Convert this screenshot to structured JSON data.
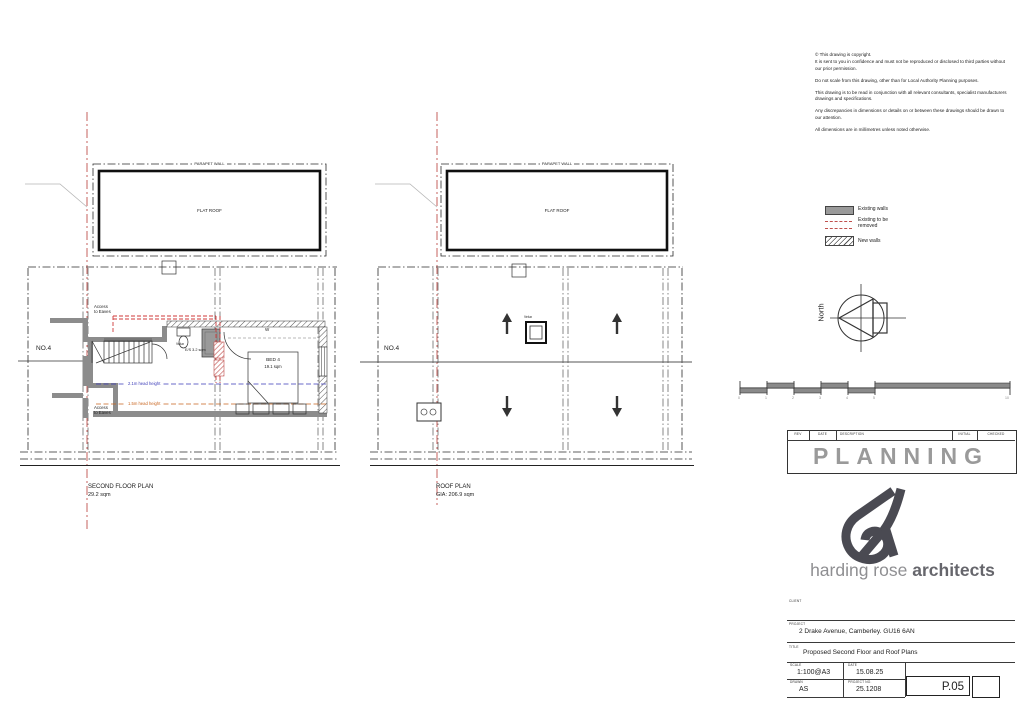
{
  "drawing_notes": {
    "paragraphs": [
      "© This drawing is copyright.",
      "It is sent to you in confidence and must not be reproduced or disclosed to third parties without our prior permission.",
      "Do not scale from this drawing, other than for Local Authority Planning purposes.",
      "This drawing is to be read in conjunction with all relevant consultants, specialist manufacturers drawings and specifications.",
      "Any discrepancies in dimensions or details on or between these drawings should be drawn to our attention.",
      "All dimensions are in millimetres unless noted otherwise."
    ]
  },
  "legend": {
    "existing_walls": "Existing walls",
    "removed_line1": "Existing to be",
    "removed_line2": "removed",
    "new_walls": "New walls"
  },
  "north_label": "North",
  "scale_bar": {
    "ticks": [
      "0",
      "1",
      "2",
      "3",
      "4",
      "5",
      "10"
    ]
  },
  "revision_table": {
    "headers": [
      "REV",
      "DATE",
      "DESCRIPTION",
      "INITIAL",
      "CHECKED"
    ],
    "status": "PLANNING"
  },
  "logo": {
    "light": "harding rose",
    "bold": "architects"
  },
  "title_block": {
    "client_label": "CLIENT",
    "project_label": "PROJECT",
    "project_value": "2 Drake Avenue, Camberley. GU16 6AN",
    "title_label": "TITLE",
    "title_value": "Proposed Second Floor and Roof Plans",
    "scale_label": "SCALE",
    "scale_value": "1:100@A3",
    "date_label": "DATE",
    "date_value": "15.08.25",
    "drawn_label": "DRAWN",
    "drawn_value": "AS",
    "project_no_label": "PROJECT NO.",
    "project_no_value": "25.1208",
    "drawing_number": "P.05"
  },
  "second_floor_plan": {
    "parapet_label": "PARAPET WALL",
    "flat_roof_label": "FLAT ROOF",
    "house_number": "NO.4",
    "access_eaves_line1": "Access",
    "access_eaves_line2": "to Eaves",
    "velux_label": "Velux",
    "ensuite_label": "E/S 3.2 sqm",
    "wardrobe_label": "W",
    "bed_label": "BED 4",
    "bed_area": "19.1 sqm",
    "head_height_21": "2.1m head height",
    "head_height_15": "1.5m head height",
    "caption_title": "SECOND FLOOR PLAN",
    "caption_area": "29.2 sqm"
  },
  "roof_plan": {
    "parapet_label": "PARAPET WALL",
    "flat_roof_label": "FLAT ROOF",
    "house_number": "NO.4",
    "velux_label": "Velux",
    "caption_title": "ROOF PLAN",
    "caption_area": "GIA: 206.9 sqm"
  }
}
